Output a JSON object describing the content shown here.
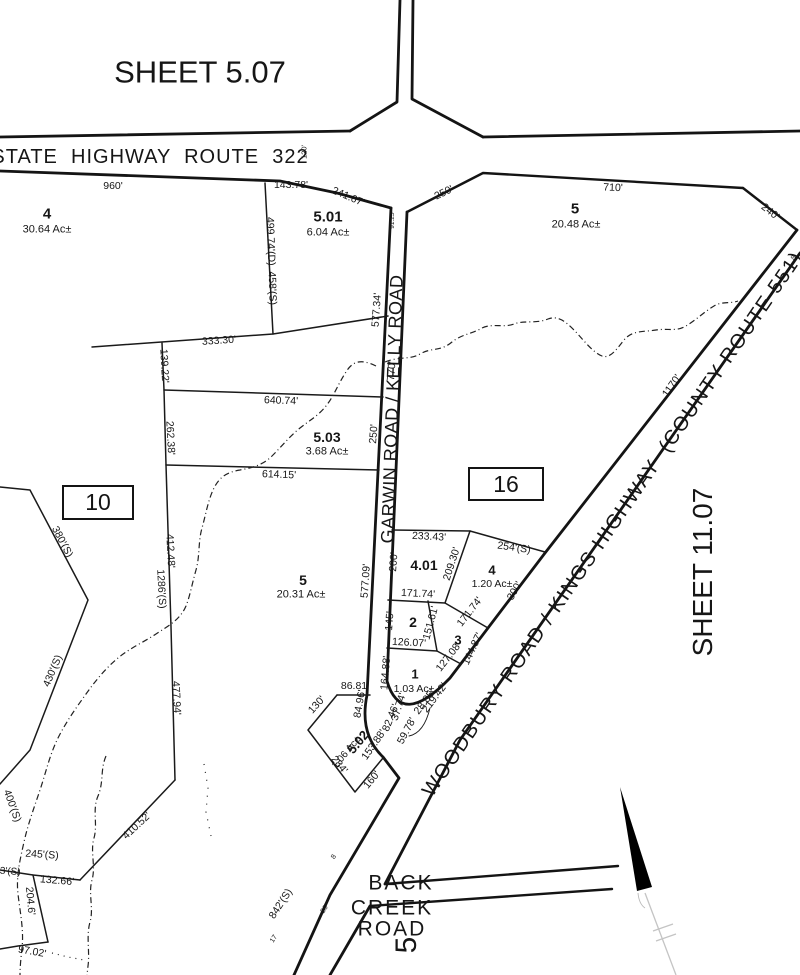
{
  "map": {
    "sheet_top": "SHEET 5.07",
    "sheet_right": "SHEET 11.07",
    "roads": {
      "top": "STATE HIGHWAY ROUTE 322",
      "vertical": "GARWIN ROAD / KELLY ROAD",
      "diagonal": "WOODBURY ROAD / KINGS HIGHWAY (COUNTY ROUTE 551)",
      "bottom": "BACK CREEK ROAD"
    },
    "blocks": [
      {
        "number": "10"
      },
      {
        "number": "16"
      }
    ],
    "parcels": [
      {
        "lot": "4",
        "acreage": "30.64 Ac±"
      },
      {
        "lot": "5.01",
        "acreage": "6.04 Ac±"
      },
      {
        "lot": "5",
        "acreage": "20.48 Ac±"
      },
      {
        "lot": "5.03",
        "acreage": "3.68 Ac±"
      },
      {
        "lot": "5",
        "acreage": "20.31 Ac±"
      },
      {
        "lot": "4.01"
      },
      {
        "lot": "4",
        "acreage": "1.20 Ac±"
      },
      {
        "lot": "2"
      },
      {
        "lot": "3"
      },
      {
        "lot": "1",
        "acreage": "1.03 Ac±"
      },
      {
        "lot": "5.02",
        "acreage": "1.06 Ac±"
      }
    ],
    "labels": [
      {
        "t": "SHEET 5.07",
        "x": 200,
        "y": 72,
        "s": 31,
        "n": "sheet-label-top"
      },
      {
        "t": "STATE  HIGHWAY  ROUTE  322",
        "x": 150,
        "y": 157,
        "s": 20,
        "ls": 1,
        "n": "road-label-route-322"
      },
      {
        "t": "SHEET 11.07",
        "x": 703,
        "y": 572,
        "r": -90,
        "s": 28,
        "n": "sheet-label-right"
      },
      {
        "t": "GARWIN ROAD / KELLY ROAD",
        "x": 392,
        "y": 409,
        "r": -88,
        "s": 18,
        "ls": 0.5,
        "n": "road-label-garwin-kelly"
      },
      {
        "t": "WOODBURY ROAD / KINGS HIGHWAY  (COUNTY ROUTE 551)",
        "x": 613,
        "y": 524,
        "r": -55.5,
        "s": 20,
        "ls": 1.5,
        "n": "road-label-woodbury-kings"
      },
      {
        "t": "BACK",
        "x": 401,
        "y": 883,
        "s": 21,
        "ls": 2,
        "n": "road-label-back"
      },
      {
        "t": "CREEK",
        "x": 392,
        "y": 908,
        "s": 21,
        "ls": 2,
        "n": "road-label-creek"
      },
      {
        "t": "ROAD",
        "x": 392,
        "y": 929,
        "s": 21,
        "ls": 2,
        "n": "road-label-road"
      },
      {
        "t": "5",
        "x": 407,
        "y": 945,
        "r": -90,
        "s": 30,
        "n": "partial-road-label"
      },
      {
        "t": "4",
        "x": 47,
        "y": 214,
        "s": 15,
        "b": 1,
        "n": "parcel-lot-label"
      },
      {
        "t": "30.64 Ac±",
        "x": 47,
        "y": 230,
        "s": 11,
        "n": "parcel-acreage-label"
      },
      {
        "t": "5.01",
        "x": 328,
        "y": 217,
        "s": 15,
        "b": 1,
        "n": "parcel-lot-label"
      },
      {
        "t": "6.04 Ac±",
        "x": 328,
        "y": 233,
        "s": 11,
        "n": "parcel-acreage-label"
      },
      {
        "t": "5",
        "x": 575,
        "y": 209,
        "s": 15,
        "b": 1,
        "n": "parcel-lot-label"
      },
      {
        "t": "20.48 Ac±",
        "x": 576,
        "y": 225,
        "s": 11,
        "n": "parcel-acreage-label"
      },
      {
        "t": "5.03",
        "x": 327,
        "y": 437,
        "s": 14,
        "b": 1,
        "n": "parcel-lot-label"
      },
      {
        "t": "3.68 Ac±",
        "x": 327,
        "y": 452,
        "s": 11,
        "n": "parcel-acreage-label"
      },
      {
        "t": "5",
        "x": 303,
        "y": 580,
        "s": 14,
        "b": 1,
        "n": "parcel-lot-label"
      },
      {
        "t": "20.31 Ac±",
        "x": 301,
        "y": 595,
        "s": 11,
        "n": "parcel-acreage-label"
      },
      {
        "t": "4.01",
        "x": 424,
        "y": 565,
        "s": 14,
        "b": 1,
        "n": "parcel-lot-label"
      },
      {
        "t": "4",
        "x": 492,
        "y": 570,
        "s": 13,
        "b": 1,
        "n": "parcel-lot-label"
      },
      {
        "t": "1.20 Ac±",
        "x": 492,
        "y": 584,
        "s": 10.5,
        "n": "parcel-acreage-label"
      },
      {
        "t": "2",
        "x": 413,
        "y": 622,
        "s": 14,
        "b": 1,
        "n": "parcel-lot-label"
      },
      {
        "t": "3",
        "x": 458,
        "y": 640,
        "s": 13,
        "b": 1,
        "n": "parcel-lot-label"
      },
      {
        "t": "1",
        "x": 415,
        "y": 674,
        "s": 13,
        "b": 1,
        "n": "parcel-lot-label"
      },
      {
        "t": "1.03 Ac±",
        "x": 414,
        "y": 689,
        "s": 10.5,
        "n": "parcel-acreage-label"
      },
      {
        "t": "5.02",
        "x": 358,
        "y": 742,
        "r": -50,
        "s": 13,
        "b": 1,
        "n": "parcel-lot-label"
      },
      {
        "t": "1.06 Ac±",
        "x": 347,
        "y": 753,
        "r": -50,
        "s": 10,
        "n": "parcel-acreage-label"
      },
      {
        "t": "960'",
        "x": 113,
        "y": 186
      },
      {
        "t": "143.78'",
        "x": 291,
        "y": 185
      },
      {
        "t": "241.67'",
        "x": 348,
        "y": 197,
        "r": 23
      },
      {
        "t": "91.25'",
        "x": 393,
        "y": 220,
        "r": -90,
        "s": 6.5
      },
      {
        "t": "120'",
        "x": 304,
        "y": 152,
        "r": -90,
        "s": 7.5
      },
      {
        "t": "250'",
        "x": 444,
        "y": 193,
        "r": -26
      },
      {
        "t": "710'",
        "x": 613,
        "y": 188,
        "r": 2
      },
      {
        "t": "240'",
        "x": 770,
        "y": 212,
        "r": 38
      },
      {
        "t": "499.74'(D)  458'(S)",
        "x": 271,
        "y": 261,
        "r": 88
      },
      {
        "t": "577.34'",
        "x": 377,
        "y": 310,
        "r": -86
      },
      {
        "t": "770'",
        "x": 392,
        "y": 371,
        "r": -86
      },
      {
        "t": "250'",
        "x": 374,
        "y": 434,
        "r": -86
      },
      {
        "t": "333.30'",
        "x": 219,
        "y": 341,
        "r": -4
      },
      {
        "t": "139.22'",
        "x": 164,
        "y": 366,
        "r": 87
      },
      {
        "t": "640.74'",
        "x": 281,
        "y": 401,
        "r": 2
      },
      {
        "t": "262.38'",
        "x": 170,
        "y": 438,
        "r": 87
      },
      {
        "t": "614.15'",
        "x": 279,
        "y": 475,
        "r": 2
      },
      {
        "t": "577.09'",
        "x": 366,
        "y": 581,
        "r": -86
      },
      {
        "t": "412.48'",
        "x": 170,
        "y": 551,
        "r": 87
      },
      {
        "t": "1286'(S)",
        "x": 161,
        "y": 589,
        "r": 87
      },
      {
        "t": "477.94'",
        "x": 176,
        "y": 698,
        "r": 87
      },
      {
        "t": "380'(S)",
        "x": 62,
        "y": 542,
        "r": 62
      },
      {
        "t": "430'(S)",
        "x": 53,
        "y": 671,
        "r": -67
      },
      {
        "t": "400'(S)",
        "x": 12,
        "y": 806,
        "r": 70
      },
      {
        "t": "245'(S)",
        "x": 42,
        "y": 855,
        "r": 4
      },
      {
        "t": "113'(S)",
        "x": 5,
        "y": 872,
        "r": 4,
        "s": 10
      },
      {
        "t": "132.66'",
        "x": 57,
        "y": 881,
        "r": 5
      },
      {
        "t": "204.6'",
        "x": 30,
        "y": 901,
        "r": 85
      },
      {
        "t": "97.02'",
        "x": 32,
        "y": 952,
        "r": 10
      },
      {
        "t": "410.52'",
        "x": 137,
        "y": 826,
        "r": -43
      },
      {
        "t": "233.43'",
        "x": 429,
        "y": 537,
        "r": 3
      },
      {
        "t": "254'(S)",
        "x": 514,
        "y": 548,
        "r": 8
      },
      {
        "t": "209.30'",
        "x": 452,
        "y": 564,
        "r": -72
      },
      {
        "t": "200'",
        "x": 394,
        "y": 562,
        "r": -86
      },
      {
        "t": "300'",
        "x": 515,
        "y": 591,
        "r": -60
      },
      {
        "t": "171.74'",
        "x": 418,
        "y": 594,
        "r": 3
      },
      {
        "t": "171.74'",
        "x": 470,
        "y": 612,
        "r": -52
      },
      {
        "t": "145'",
        "x": 390,
        "y": 621,
        "r": -86
      },
      {
        "t": "151.61'",
        "x": 431,
        "y": 623,
        "r": -75
      },
      {
        "t": "126.07'",
        "x": 409,
        "y": 643,
        "r": 3
      },
      {
        "t": "127.08'",
        "x": 449,
        "y": 657,
        "r": -52
      },
      {
        "t": "144.87'",
        "x": 473,
        "y": 649,
        "r": -65
      },
      {
        "t": "1170'",
        "x": 672,
        "y": 386,
        "r": -55
      },
      {
        "t": "164.88'",
        "x": 386,
        "y": 673,
        "r": -85
      },
      {
        "t": "86.81'",
        "x": 355,
        "y": 686
      },
      {
        "t": "84.96'",
        "x": 360,
        "y": 704,
        "r": -80
      },
      {
        "t": "130'",
        "x": 317,
        "y": 705,
        "r": -48
      },
      {
        "t": "153.88'",
        "x": 374,
        "y": 745,
        "r": -55
      },
      {
        "t": "284'",
        "x": 339,
        "y": 765,
        "r": 50
      },
      {
        "t": "160'",
        "x": 372,
        "y": 780,
        "r": -50
      },
      {
        "t": "37.74'",
        "x": 399,
        "y": 707,
        "r": -72
      },
      {
        "t": "82.46'",
        "x": 391,
        "y": 718,
        "r": -68
      },
      {
        "t": "59.78'",
        "x": 407,
        "y": 731,
        "r": -62
      },
      {
        "t": "28.85'",
        "x": 425,
        "y": 702,
        "r": -53
      },
      {
        "t": "219.42'",
        "x": 435,
        "y": 698,
        "r": -53
      },
      {
        "t": "842'(S)",
        "x": 281,
        "y": 904,
        "r": -57
      },
      {
        "t": "8",
        "x": 334,
        "y": 857,
        "r": -57,
        "s": 7
      },
      {
        "t": "26'",
        "x": 325,
        "y": 909,
        "r": -57,
        "s": 7
      },
      {
        "t": "17",
        "x": 274,
        "y": 939,
        "r": -57,
        "s": 7
      },
      {
        "t": "8",
        "x": 794,
        "y": 258,
        "r": -56,
        "s": 7
      }
    ]
  }
}
